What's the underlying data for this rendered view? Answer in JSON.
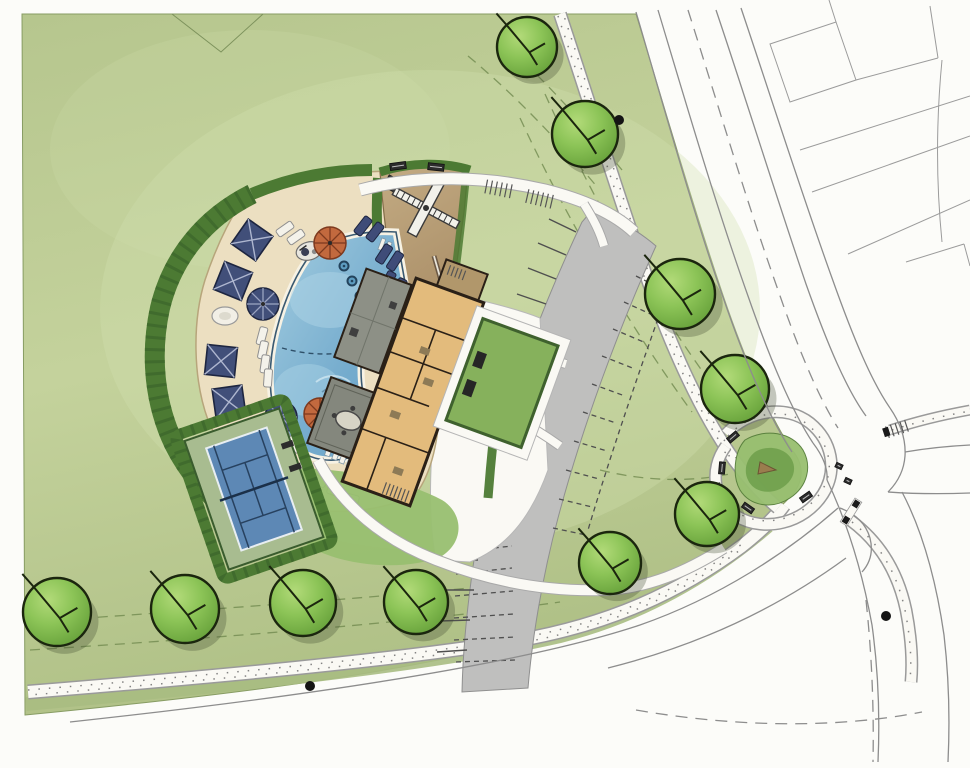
{
  "plan": {
    "kind": "landscape-site-plan",
    "colors": {
      "paper": "#fcfcf9",
      "lawn-edge": "#879c63",
      "verge": "#a9bd82",
      "hedge": "#4c7a33",
      "hedge-dark": "#38602a",
      "deck": "#ecdfc1",
      "deck-edge": "#b7a57b",
      "pool-edge": "#3a5a72",
      "coping": "#f7f2e4",
      "navy": "#414f79",
      "navy-dark": "#1d2540",
      "orange": "#c2693e",
      "orange-dark": "#7e3a1f",
      "parking": "#bfbfbe",
      "stall": "#4f4f4f",
      "sand-edge": "#826c48",
      "wall": "#2a2017",
      "building": "#e3bb7c",
      "roof": "#8d9086",
      "roof-dark": "#84877d",
      "court": "#5d88b5",
      "court-line": "#27415f",
      "surround": "#a8bc90",
      "grass2": "#98bf70",
      "road-line": "#8d8d8d",
      "lot-line": "#9b9b9b",
      "walk": "#faf9f4",
      "tree-line": "#1b260e",
      "shadow": "#3f4a2e",
      "dot": "#141414",
      "dash-green": "#70894f",
      "prop-line": "#7d925c"
    },
    "trees": [
      [
        527,
        47,
        30
      ],
      [
        585,
        134,
        33
      ],
      [
        680,
        294,
        35
      ],
      [
        735,
        389,
        34
      ],
      [
        707,
        514,
        32
      ],
      [
        610,
        563,
        31
      ],
      [
        57,
        612,
        34
      ],
      [
        185,
        609,
        34
      ],
      [
        303,
        603,
        33
      ],
      [
        416,
        602,
        32
      ]
    ],
    "umbrellas": [
      {
        "x": 263,
        "y": 304,
        "type": "navy"
      },
      {
        "x": 281,
        "y": 417,
        "type": "navy"
      },
      {
        "x": 330,
        "y": 243,
        "type": "orange"
      },
      {
        "x": 320,
        "y": 414,
        "type": "orange"
      }
    ],
    "cabanas": [
      [
        252,
        240,
        35
      ],
      [
        233,
        281,
        22
      ],
      [
        221,
        361,
        6
      ],
      [
        229,
        402,
        -8
      ]
    ],
    "loungers_navy": [
      [
        363,
        226,
        38
      ],
      [
        375,
        232,
        38
      ],
      [
        384,
        254,
        33
      ],
      [
        395,
        261,
        33
      ],
      [
        388,
        281,
        28
      ],
      [
        399,
        288,
        28
      ]
    ],
    "loungers_white": [
      [
        285,
        229,
        55
      ],
      [
        296,
        237,
        55
      ],
      [
        262,
        336,
        15
      ],
      [
        263,
        350,
        12
      ],
      [
        265,
        364,
        8
      ],
      [
        268,
        378,
        4
      ],
      [
        284,
        432,
        -25
      ],
      [
        295,
        444,
        -30
      ],
      [
        306,
        470,
        -50
      ],
      [
        318,
        480,
        -55
      ],
      [
        336,
        492,
        -70
      ],
      [
        350,
        498,
        -75
      ]
    ],
    "benches": [
      [
        398,
        166,
        -8,
        16,
        7
      ],
      [
        436,
        167,
        6,
        16,
        7
      ],
      [
        733,
        437,
        -40,
        12,
        6
      ],
      [
        722,
        468,
        -85,
        12,
        6
      ],
      [
        748,
        508,
        -145,
        12,
        6
      ],
      [
        806,
        497,
        145,
        12,
        6
      ],
      [
        503,
        378,
        -85,
        11,
        5
      ],
      [
        496,
        440,
        -85,
        11,
        5
      ],
      [
        839,
        466,
        25,
        7,
        5
      ],
      [
        848,
        481,
        25,
        7,
        5
      ]
    ],
    "tables": [
      [
        225,
        316
      ]
    ],
    "dots": [
      [
        619,
        120
      ],
      [
        310,
        686
      ],
      [
        886,
        616
      ]
    ],
    "bubblers": [
      [
        344,
        266
      ],
      [
        352,
        281
      ],
      [
        360,
        296
      ]
    ]
  }
}
